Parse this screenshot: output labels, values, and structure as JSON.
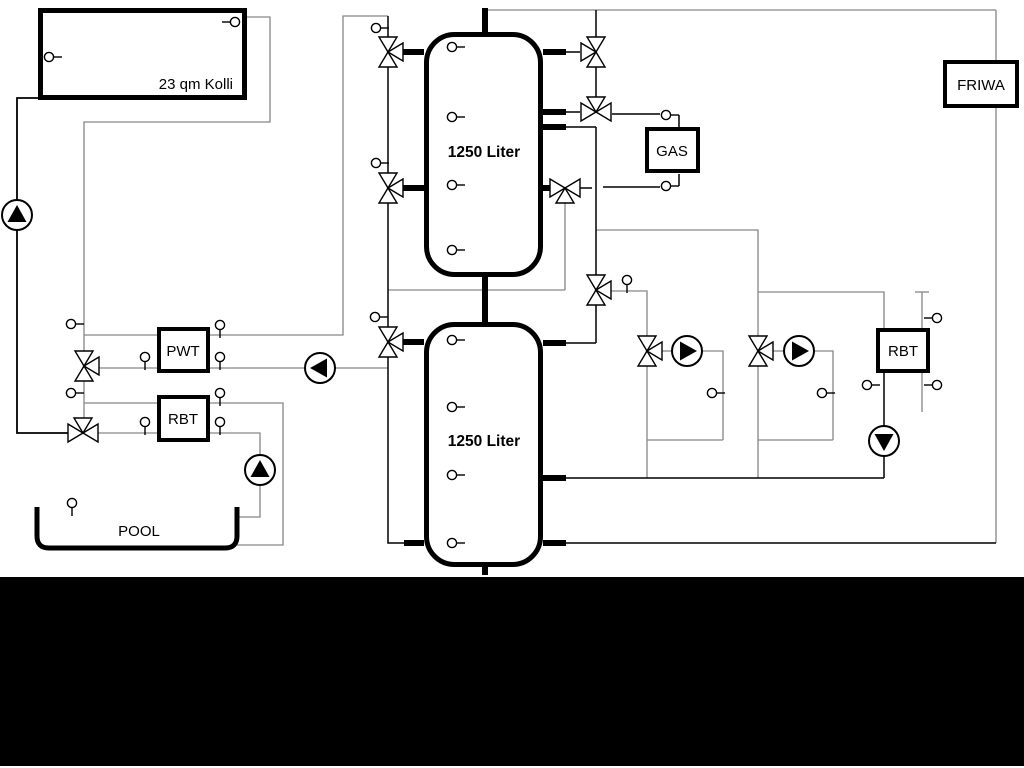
{
  "diagram": {
    "title_hint": "hydraulic heating schematic",
    "labels": {
      "collector": "23 qm Kolli",
      "tank_top": "1250 Liter",
      "tank_bottom": "1250 Liter",
      "gas": "GAS",
      "friwa": "FRIWA",
      "pwt": "PWT",
      "rbt_left": "RBT",
      "rbt_right": "RBT",
      "pool": "POOL"
    },
    "colors": {
      "line_primary": "#000000",
      "line_secondary": "#868686",
      "background": "#ffffff",
      "bottom_bar": "#000000"
    }
  }
}
